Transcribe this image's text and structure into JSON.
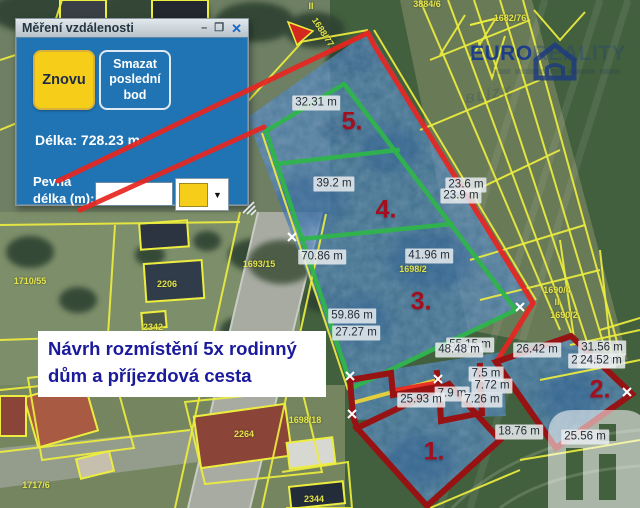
{
  "dialog": {
    "title": "Měření vzdálenosti",
    "icons": {
      "minimize": "–",
      "maximize": "❐",
      "close": "✕",
      "dropdown": "▼"
    },
    "buttons": {
      "again": "Znovu",
      "delete_last": "Smazat poslední bod"
    },
    "length_text": "Délka: 728.23 m",
    "fixed_length_label": "Pevná délka (m):",
    "fixed_length_value": "",
    "colors": {
      "panel": "#2074b4",
      "button_yellow": "#f6ce19",
      "swatch": "#f6ce19"
    }
  },
  "note": {
    "line1": "Návrh rozmístění 5x rodinný",
    "line2": "dům a příjezdová cesta"
  },
  "watermark": {
    "brand_bold": "EURO",
    "brand_light": "REALITY",
    "ghost": "BLÍZK"
  },
  "parcel_numbers": [
    {
      "text": "5.",
      "x": 352,
      "y": 122
    },
    {
      "text": "4.",
      "x": 386,
      "y": 210
    },
    {
      "text": "3.",
      "x": 421,
      "y": 302
    },
    {
      "text": "2.",
      "x": 600,
      "y": 390
    },
    {
      "text": "1.",
      "x": 434,
      "y": 452
    }
  ],
  "measurements": [
    {
      "text": "32.31 m",
      "x": 316,
      "y": 103
    },
    {
      "text": "39.2 m",
      "x": 334,
      "y": 184
    },
    {
      "text": "23.6 m",
      "x": 466,
      "y": 185
    },
    {
      "text": "23.9 m",
      "x": 461,
      "y": 196
    },
    {
      "text": "70.86 m",
      "x": 322,
      "y": 257
    },
    {
      "text": "41.96 m",
      "x": 429,
      "y": 256
    },
    {
      "text": "59.86 m",
      "x": 352,
      "y": 316
    },
    {
      "text": "27.27 m",
      "x": 356,
      "y": 333
    },
    {
      "text": "55.15 m",
      "x": 470,
      "y": 345
    },
    {
      "text": "48.48 m",
      "x": 459,
      "y": 350
    },
    {
      "text": "26.42 m",
      "x": 537,
      "y": 350
    },
    {
      "text": "31.56 m",
      "x": 602,
      "y": 348
    },
    {
      "text": "23.45 m",
      "x": 592,
      "y": 361
    },
    {
      "text": "24.52 m",
      "x": 601,
      "y": 361
    },
    {
      "text": "7.5 m",
      "x": 486,
      "y": 374
    },
    {
      "text": "7.72 m",
      "x": 492,
      "y": 386
    },
    {
      "text": "7.9 m",
      "x": 452,
      "y": 394
    },
    {
      "text": "7.26 m",
      "x": 482,
      "y": 400
    },
    {
      "text": "25.93 m",
      "x": 421,
      "y": 400
    },
    {
      "text": "18.76 m",
      "x": 519,
      "y": 432
    },
    {
      "text": "25.56 m",
      "x": 585,
      "y": 437
    }
  ],
  "cadastral_labels": [
    {
      "text": "3884/6",
      "x": 427,
      "y": 4,
      "rot": 0
    },
    {
      "text": "II",
      "x": 311,
      "y": 6,
      "rot": 0
    },
    {
      "text": "1688/77",
      "x": 323,
      "y": 32,
      "rot": 57
    },
    {
      "text": "1682/76",
      "x": 510,
      "y": 18,
      "rot": 0
    },
    {
      "text": "1690/4",
      "x": 557,
      "y": 290,
      "rot": 0
    },
    {
      "text": "II",
      "x": 557,
      "y": 302,
      "rot": 0
    },
    {
      "text": "1690/2",
      "x": 564,
      "y": 315,
      "rot": 0
    },
    {
      "text": "1710/55",
      "x": 30,
      "y": 281,
      "rot": 0
    },
    {
      "text": "2206",
      "x": 167,
      "y": 284,
      "rot": 0
    },
    {
      "text": "2342",
      "x": 153,
      "y": 327,
      "rot": 0
    },
    {
      "text": "1693/15",
      "x": 259,
      "y": 264,
      "rot": 0
    },
    {
      "text": "1698/2",
      "x": 413,
      "y": 269,
      "rot": 0
    },
    {
      "text": "2264",
      "x": 244,
      "y": 434,
      "rot": 0
    },
    {
      "text": "1698/18",
      "x": 305,
      "y": 420,
      "rot": 0
    },
    {
      "text": "2344",
      "x": 314,
      "y": 499,
      "rot": 0
    },
    {
      "text": "1717/6",
      "x": 36,
      "y": 485,
      "rot": 0
    }
  ]
}
